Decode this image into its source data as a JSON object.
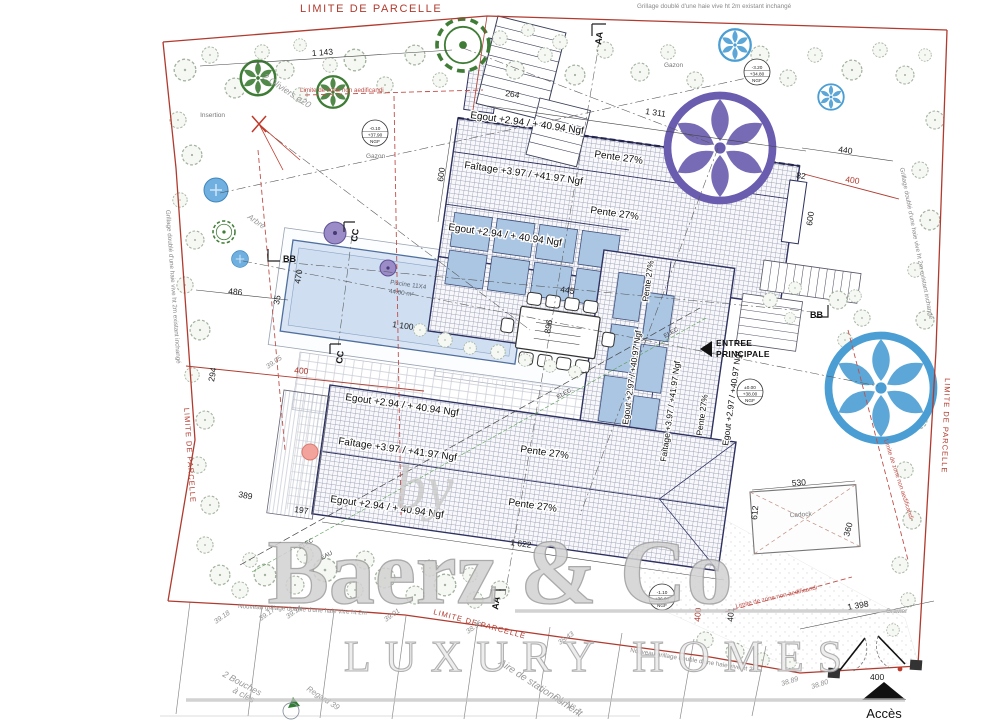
{
  "plan": {
    "boundary": {
      "label": "LIMITE DE PARCELLE"
    },
    "fence": {
      "existing": "Grillage doublé d'une haie vive ht 2m existant inchangé",
      "new": "Nouveau grillage double d'une haie vive ht 2m"
    },
    "zone": {
      "non_aedificandi": "Limite de zone non aedificandi"
    },
    "roofs": {
      "egout_294": "Egout +2.94 / + 40.94 Ngf",
      "egout_297": "Egout +2.97 / +40.97 Ngf",
      "faitage": "Faîtage +3.97 / +41.97 Ngf",
      "pente": "Pente 27%"
    },
    "pool": {
      "name": "Piscine 11X4",
      "area": "44.00 m²"
    },
    "entrance": {
      "l1": "ENTREE",
      "l2": "PRINCIPALE"
    },
    "carport": "Cadock",
    "access": "Accès",
    "ground": {
      "gazon": "Gazon",
      "gravier": "Gravier"
    },
    "misc": {
      "insertion": "Insertion",
      "oliviers": "2 Oliviers ø20",
      "arbre": "Arbre",
      "bouches_l1": "2 Bouches",
      "bouches_l2": "à clés",
      "regard": "Regard 39",
      "parking": "Aire de stationnement",
      "dl": "DL N° 1"
    },
    "levels": {
      "garden_nw": [
        "-0.10",
        "+37.90",
        "NGF"
      ],
      "garden_ne": [
        "-3.20",
        "+34.80",
        "NGF"
      ],
      "entrance": [
        "±0.00",
        "+38.00",
        "NGF"
      ],
      "gate": [
        "-1.10",
        "+36.90",
        "NGF"
      ]
    },
    "spots": [
      "39.18",
      "39.17",
      "39.14",
      "39.05",
      "39.01",
      "38.96",
      "38.43",
      "38.89",
      "38.80"
    ],
    "dims": {
      "n1311": "1 311",
      "n1143": "1 143",
      "n264": "264",
      "n600": "600",
      "n440": "440",
      "n82": "82",
      "n486": "486",
      "n35": "35",
      "n294": "294",
      "n470": "470",
      "n1100": "1 100",
      "n896": "896",
      "n445": "445",
      "n197": "197",
      "n389": "389",
      "n1622": "1 622",
      "n530": "530",
      "n612": "612",
      "n360": "360",
      "n401": "401",
      "n1398": "1 398",
      "n400": "400"
    },
    "sections": {
      "aa": "AA",
      "bb": "BB",
      "cc": "CC"
    },
    "utilities": {
      "elec": "ELEC",
      "eau": "EAU"
    }
  },
  "watermark": {
    "by": "by",
    "brand": "Baerz & Co",
    "tagline": "LUXURY HOMES"
  },
  "colors": {
    "boundary": "#b03a2e",
    "roof_outline": "#2e3160",
    "roof_hatch": "#9aa0b6",
    "panel": "#abc6e2",
    "pool_fill": "#d9e4f4",
    "tree_green": "#3f7d36",
    "tree_blue": "#5aa7dc",
    "tree_purple": "#6a5cae",
    "vegetation": "#a3b29e",
    "watermark": "#c6c6c6"
  }
}
